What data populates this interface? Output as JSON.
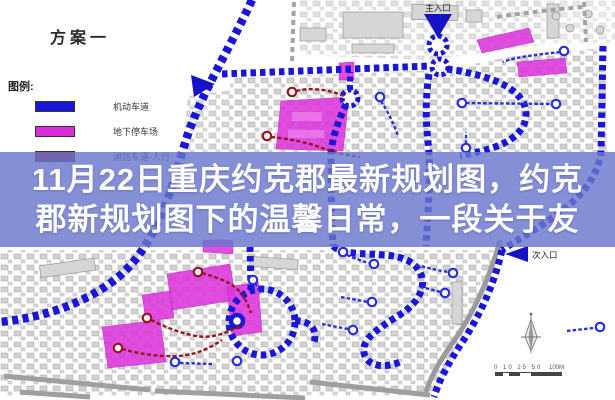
{
  "header": {
    "plan_title": "方案一"
  },
  "legend": {
    "heading": "图例:",
    "items": [
      {
        "label": "机动车道",
        "color": "#1a16d6"
      },
      {
        "label": "地下停车场",
        "color": "#d92ed9"
      },
      {
        "label": "消防车道-人行",
        "color": "#9a1420"
      }
    ]
  },
  "map": {
    "main_entrance_label": "主入口",
    "secondary_entrance_label": "次入口",
    "scale_ticks": "0 10 25 50",
    "scale_end": "100M"
  },
  "overlay": {
    "line1": "11月22日重庆约克郡最新规划图，约克",
    "line2": "郡新规划图下的温馨日常，一段关于友",
    "background": "rgba(106,118,205,0.82)",
    "text_color": "#ffffff"
  },
  "colors": {
    "road_blue": "#1a16d6",
    "path_blue": "#2a2fd8",
    "parking_magenta": "#d92ed9",
    "fire_lane_red": "#9a1420",
    "building_gray": "#c9c9c9",
    "road_gray": "#9b9b9b"
  }
}
